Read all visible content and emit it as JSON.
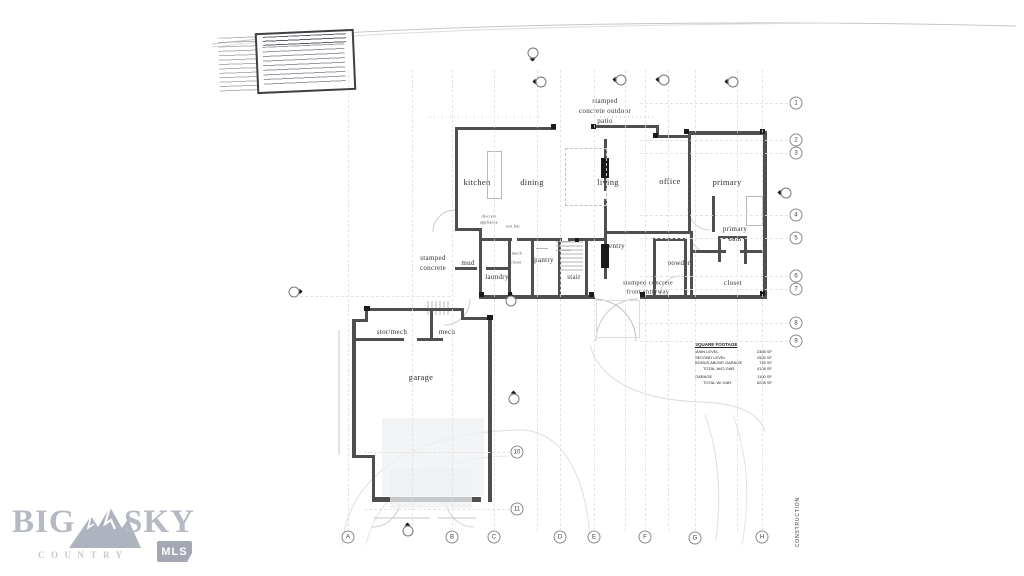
{
  "branding": {
    "big": "BIG",
    "sky": "SKY",
    "country": "COUNTRY",
    "mls": "MLS",
    "logo_color": "#b5b9c3",
    "badge_color": "#a3a8b4"
  },
  "rooms": {
    "kitchen": "kitchen",
    "dining": "dining",
    "living": "living",
    "office": "office",
    "primary": "primary",
    "primary_bath_1": "primary",
    "primary_bath_2": "bath",
    "entry": "entry",
    "mud": "mud",
    "laundry": "laundry",
    "pantry": "pantry",
    "stair": "stair",
    "powder": "powder",
    "closet_primary": "closet",
    "closet_small": "closet",
    "mech_small": "mech",
    "stor_mech": "stor/mech",
    "mech": "mech",
    "garage": "garage"
  },
  "site_labels": {
    "stamped_concrete_1": "stamped",
    "stamped_concrete_2": "concrete",
    "patio_1": "stamped",
    "patio_2": "concrete outdoor",
    "patio_3": "patio",
    "front_entry_1": "stamped concrete",
    "front_entry_2": "front entryway",
    "wet_bar": "wet bar",
    "appliance_1": "discrete",
    "appliance_2": "appliance"
  },
  "sqft_table": {
    "title": "SQUARE FOOTAGE",
    "rows": [
      {
        "label": "MAIN LEVEL",
        "value": "2385 SF"
      },
      {
        "label": "SECOND LEVEL",
        "value": "1525 SF"
      },
      {
        "label": "BONUS ABOVE GARAGE",
        "value": "745 SF"
      },
      {
        "label": "TOTAL W/O GAR.",
        "value": "4128 SF"
      },
      {
        "label": "GARAGE",
        "value": "1100 SF"
      },
      {
        "label": "TOTAL W/ GAR.",
        "value": "5228 SF"
      }
    ]
  },
  "grid": {
    "columns": [
      "A",
      "B",
      "C",
      "D",
      "E",
      "F",
      "G",
      "H"
    ],
    "rows": [
      "1",
      "2",
      "3",
      "4",
      "5",
      "6",
      "7",
      "8",
      "9",
      "10",
      "11"
    ]
  },
  "side_text": "CONSTRUCTION"
}
